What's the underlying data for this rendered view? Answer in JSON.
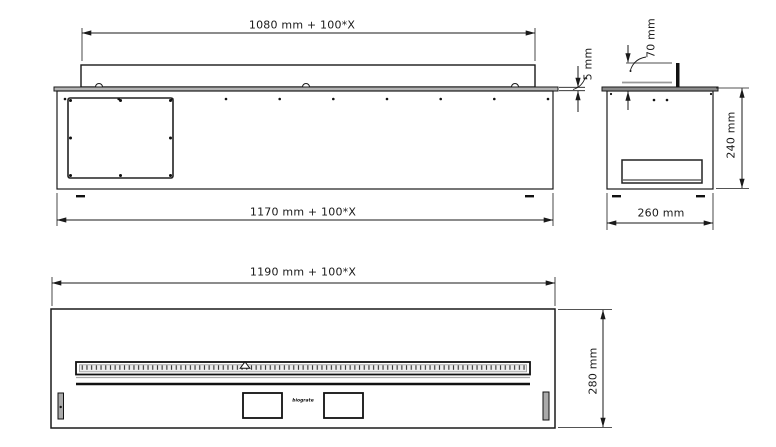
{
  "drawing": {
    "title": "Modular linear fireplace insert dimensional drawing",
    "side_view": {
      "lid_length_label": "1080 mm + 100*X",
      "body_length_label": "1170 mm + 100*X",
      "top_plate_thickness_label": "5 mm"
    },
    "section_view": {
      "lid_height_label": "70 mm",
      "body_height_label": "240 mm",
      "body_depth_label": "260 mm"
    },
    "front_view": {
      "front_length_label": "1190 mm + 100*X",
      "front_height_label": "280 mm",
      "brand_mark": "biograte"
    },
    "colors": {
      "line": "#1a1a1a",
      "plate_gray": "#b3b3b3",
      "background": "#ffffff"
    }
  }
}
